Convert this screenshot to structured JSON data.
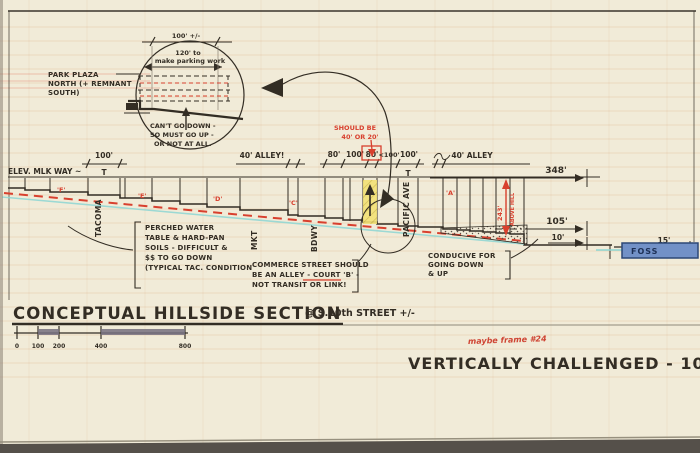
{
  "colors": {
    "paper": "#f1ebd8",
    "ink": "#332d24",
    "red_ink": "#d8402e",
    "cyan_line": "#8ed7d4",
    "yellow_highlight": "#f2e175",
    "foss_blue": "#7291c7",
    "scale_fill": "#76707f"
  },
  "detail_bubble": {
    "dim_top": "100' +/-",
    "dim_mid_line1": "120' to",
    "dim_mid_line2": "make parking work",
    "note_line1": "CAN'T GO DOWN -",
    "note_line2": "SO MUST GO UP -",
    "note_line3": "OR NOT AT ALL."
  },
  "park_plaza": {
    "line1": "PARK PLAZA",
    "line2": "NORTH (+ REMNANT",
    "line3": "SOUTH)"
  },
  "elev_label": "ELEV. MLK WAY ~",
  "dims": {
    "left_100": "100'",
    "left_T": "T",
    "alley_left": "40' ALLEY!",
    "w80a": "80'",
    "w100a": "100'",
    "w80b": "80'",
    "w100b": "<100'",
    "w100c": "100'",
    "right_T": "T",
    "alley_right": "40' ALLEY",
    "total": "348'",
    "upper": "105'",
    "lower": "10'",
    "foss_width": "15'",
    "height_red": "243'",
    "height_red_note": "ABOVE HILL"
  },
  "red_note": {
    "line1": "SHOULD BE",
    "line2": "40' OR 20'"
  },
  "streets": {
    "s1": "TACOMA",
    "s2": "MKT",
    "s3": "BDWY",
    "s4": "PACIFIC AVE"
  },
  "block_letters": [
    "'F'",
    "'E'",
    "'D'",
    "'C'",
    "'A'"
  ],
  "soils_note": [
    "PERCHED WATER",
    "TABLE & HARD-PAN",
    "SOILS - DIFFICULT &",
    "$$ TO GO DOWN",
    "(TYPICAL TAC. CONDITION"
  ],
  "commerce_note": [
    "COMMERCE STREET SHOULD",
    "BE AN ALLEY - COURT 'B' -",
    "NOT TRANSIT OR LINK!"
  ],
  "conducive_note": [
    "CONDUCIVE FOR",
    "GOING DOWN",
    "& UP"
  ],
  "water_label": "FOSS",
  "section_title": {
    "main": "CONCEPTUAL HILLSIDE SECTION",
    "location": "@ S.10th STREET +/-"
  },
  "scale_bar": {
    "ticks": [
      "0",
      "100",
      "200",
      "400",
      "800"
    ]
  },
  "footer": {
    "title": "VERTICALLY CHALLENGED - 101",
    "pencil_note": "maybe frame #24"
  }
}
